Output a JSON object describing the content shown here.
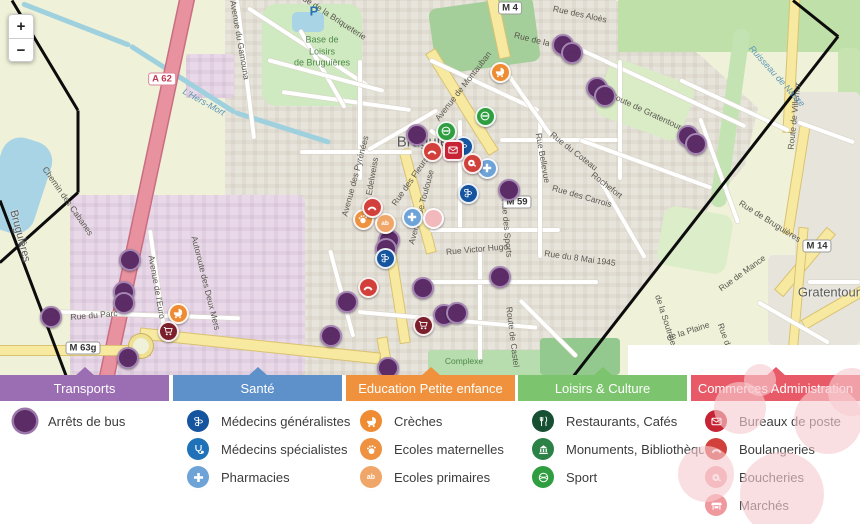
{
  "map": {
    "controls": {
      "zoom_in": "+",
      "zoom_out": "−"
    },
    "towns": [
      {
        "text": "Bruguières",
        "x": 433,
        "y": 142,
        "size": 15,
        "rot": 0
      },
      {
        "text": "Gratentour",
        "x": 829,
        "y": 292,
        "size": 13,
        "rot": 0
      },
      {
        "text": "Bruguières",
        "x": 20,
        "y": 236,
        "size": 11,
        "rot": 75
      }
    ],
    "park_label": {
      "lines": [
        "Base de",
        "Loisirs",
        "de Bruguières"
      ],
      "x": 322,
      "y": 52
    },
    "area_label": {
      "text": "Complexe",
      "x": 464,
      "y": 361
    },
    "parking_label": {
      "text": "P",
      "x": 314,
      "y": 11
    },
    "water_labels": [
      {
        "text": "L'Hers-Mort",
        "x": 204,
        "y": 102,
        "rot": 29
      },
      {
        "text": "Ruisseau de Nauze",
        "x": 777,
        "y": 76,
        "rot": 48
      }
    ],
    "street_labels": [
      {
        "text": "Rue de la Briqueterie",
        "x": 332,
        "y": 16,
        "rot": 33
      },
      {
        "text": "Avenue du Gamouna",
        "x": 240,
        "y": 40,
        "rot": 80
      },
      {
        "text": "Avenue de Montauban",
        "x": 463,
        "y": 86,
        "rot": -52
      },
      {
        "text": "Rue des Aloès",
        "x": 580,
        "y": 14,
        "rot": 12
      },
      {
        "text": "Rue de la",
        "x": 532,
        "y": 39,
        "rot": 14
      },
      {
        "text": "Route de Gratentour",
        "x": 646,
        "y": 111,
        "rot": 25
      },
      {
        "text": "Rue du Coteau",
        "x": 574,
        "y": 151,
        "rot": 38
      },
      {
        "text": "Rochefort",
        "x": 607,
        "y": 185,
        "rot": 38
      },
      {
        "text": "Rue Bellevue",
        "x": 543,
        "y": 158,
        "rot": 80
      },
      {
        "text": "Rue des Carrois",
        "x": 582,
        "y": 196,
        "rot": 16
      },
      {
        "text": "Rue du 8 Mai 1945",
        "x": 580,
        "y": 258,
        "rot": 8
      },
      {
        "text": "Rue de Bruguières",
        "x": 770,
        "y": 221,
        "rot": 32
      },
      {
        "text": "Rue de Mance",
        "x": 742,
        "y": 273,
        "rot": -36
      },
      {
        "text": "Rue du Barry",
        "x": 729,
        "y": 347,
        "rot": 70
      },
      {
        "text": "de la Plaine",
        "x": 688,
        "y": 331,
        "rot": -18
      },
      {
        "text": "de la Soutrine",
        "x": 666,
        "y": 320,
        "rot": 72
      },
      {
        "text": "Avenue des Pyrénées",
        "x": 355,
        "y": 176,
        "rot": -75
      },
      {
        "text": "Rue des Edelweiss",
        "x": 369,
        "y": 193,
        "rot": -80
      },
      {
        "text": "Rue des Fleurs",
        "x": 410,
        "y": 181,
        "rot": -55
      },
      {
        "text": "Avenue de Toulouse",
        "x": 421,
        "y": 207,
        "rot": -75
      },
      {
        "text": "Rue Victor Hugo",
        "x": 477,
        "y": 249,
        "rot": -5
      },
      {
        "text": "Rue des Sports",
        "x": 507,
        "y": 228,
        "rot": 85
      },
      {
        "text": "Route de Castel",
        "x": 513,
        "y": 337,
        "rot": 83
      },
      {
        "text": "Rue du Parc",
        "x": 94,
        "y": 315,
        "rot": -5
      },
      {
        "text": "Avenue de l'Euro",
        "x": 157,
        "y": 287,
        "rot": 80
      },
      {
        "text": "Chemin des Cabanes",
        "x": 68,
        "y": 201,
        "rot": 55
      },
      {
        "text": "Autoroute des Deux Mers",
        "x": 206,
        "y": 283,
        "rot": 76
      },
      {
        "text": "Route de Villemur",
        "x": 794,
        "y": 116,
        "rot": -84
      }
    ],
    "shields": [
      {
        "text": "A 62",
        "x": 162,
        "y": 79,
        "kind": "motorway"
      },
      {
        "text": "M 4",
        "x": 510,
        "y": 8,
        "kind": "local"
      },
      {
        "text": "M 59",
        "x": 517,
        "y": 202,
        "kind": "local"
      },
      {
        "text": "M 14",
        "x": 817,
        "y": 246,
        "kind": "local"
      },
      {
        "text": "M 63g",
        "x": 83,
        "y": 348,
        "kind": "local"
      }
    ],
    "regions": [
      {
        "x": 186,
        "y": 54,
        "w": 48,
        "h": 44,
        "rot": 0,
        "color": "#e9d9e8",
        "cls": "indu",
        "r": 4
      },
      {
        "x": 70,
        "y": 195,
        "w": 235,
        "h": 180,
        "rot": 0,
        "color": "#e9d9e8",
        "cls": "indu",
        "r": 8
      },
      {
        "x": 262,
        "y": 4,
        "w": 100,
        "h": 102,
        "rot": 0,
        "color": "#cfe9c0",
        "r": 14
      },
      {
        "x": 292,
        "y": 12,
        "w": 32,
        "h": 20,
        "rot": 0,
        "color": "#a9d4e5",
        "r": 5
      },
      {
        "x": 432,
        "y": 2,
        "w": 105,
        "h": 66,
        "rot": -8,
        "color": "#a4cf9a",
        "r": 8
      },
      {
        "x": 618,
        "y": 0,
        "w": 242,
        "h": 52,
        "rot": 0,
        "color": "#bfe0a8",
        "r": 0
      },
      {
        "x": 838,
        "y": 48,
        "w": 22,
        "h": 80,
        "rot": 0,
        "color": "#c7e4b0",
        "r": 6
      },
      {
        "x": 722,
        "y": 28,
        "w": 16,
        "h": 180,
        "rot": 8,
        "color": "#c3e3b2",
        "r": 8
      },
      {
        "x": 600,
        "y": 70,
        "w": 90,
        "h": 60,
        "rot": 20,
        "color": "#d9ecc6",
        "r": 12
      },
      {
        "x": 660,
        "y": 210,
        "w": 70,
        "h": 60,
        "rot": 10,
        "color": "#dcedc9",
        "r": 12
      },
      {
        "x": 795,
        "y": 92,
        "w": 65,
        "h": 170,
        "rot": 0,
        "color": "#e7e4dc",
        "r": 6
      },
      {
        "x": 768,
        "y": 255,
        "w": 92,
        "h": 90,
        "rot": 0,
        "color": "#e7e4dc",
        "r": 6
      },
      {
        "x": 428,
        "y": 350,
        "w": 130,
        "h": 25,
        "rot": 0,
        "color": "#b7dcae",
        "r": 4
      },
      {
        "x": 540,
        "y": 338,
        "w": 80,
        "h": 37,
        "rot": 0,
        "color": "#93c98f",
        "r": 4
      },
      {
        "x": -8,
        "y": 138,
        "w": 52,
        "h": 95,
        "rot": 18,
        "color": "#a9d4e5",
        "r": 20
      }
    ],
    "rivers": [
      [
        22,
        3,
        130,
        45
      ],
      [
        130,
        45,
        235,
        112
      ],
      [
        235,
        112,
        330,
        142
      ]
    ],
    "motorway": {
      "x": 140,
      "y": -12,
      "w": 13,
      "h": 404,
      "rot": 12
    },
    "yellow_roads": [
      {
        "x": 493,
        "y": -8,
        "w": 10,
        "h": 66,
        "rot": -12
      },
      {
        "x": 457,
        "y": 43,
        "w": 10,
        "h": 118,
        "rot": -32
      },
      {
        "x": 413,
        "y": 148,
        "w": 9,
        "h": 106,
        "rot": -15
      },
      {
        "x": 393,
        "y": 245,
        "w": 9,
        "h": 98,
        "rot": -9
      },
      {
        "x": 381,
        "y": 338,
        "w": 9,
        "h": 40,
        "rot": -10
      },
      {
        "x": 0,
        "y": 346,
        "w": 150,
        "h": 9,
        "rot": 0
      },
      {
        "x": 140,
        "y": 341,
        "w": 240,
        "h": 10,
        "rot": 6
      },
      {
        "x": 787,
        "y": -4,
        "w": 9,
        "h": 136,
        "rot": 3
      },
      {
        "x": 792,
        "y": 126,
        "w": 9,
        "h": 108,
        "rot": 9
      },
      {
        "x": 800,
        "y": 222,
        "w": 10,
        "h": 80,
        "rot": 40
      },
      {
        "x": 830,
        "y": 272,
        "w": 9,
        "h": 70,
        "rot": 60
      },
      {
        "x": 793,
        "y": 228,
        "w": 8,
        "h": 150,
        "rot": 5
      }
    ],
    "roundabout": {
      "x": 137,
      "y": 342
    },
    "streets": [
      [
        248,
        8,
        33,
        150
      ],
      [
        237,
        0,
        83,
        140
      ],
      [
        282,
        92,
        8,
        130
      ],
      [
        300,
        30,
        60,
        90
      ],
      [
        360,
        60,
        90,
        120
      ],
      [
        300,
        152,
        0,
        112
      ],
      [
        430,
        130,
        35,
        80
      ],
      [
        460,
        120,
        90,
        110
      ],
      [
        430,
        230,
        0,
        130
      ],
      [
        500,
        140,
        0,
        118
      ],
      [
        540,
        118,
        90,
        140
      ],
      [
        480,
        252,
        90,
        108
      ],
      [
        430,
        282,
        0,
        168
      ],
      [
        358,
        312,
        5,
        180
      ],
      [
        520,
        300,
        45,
        80
      ],
      [
        560,
        40,
        25,
        205
      ],
      [
        620,
        60,
        90,
        120
      ],
      [
        680,
        80,
        25,
        120
      ],
      [
        580,
        140,
        20,
        140
      ],
      [
        600,
        180,
        60,
        90
      ],
      [
        330,
        250,
        75,
        90
      ],
      [
        60,
        312,
        2,
        180
      ],
      [
        150,
        230,
        82,
        112
      ],
      [
        700,
        118,
        70,
        112
      ],
      [
        798,
        122,
        20,
        60
      ],
      [
        808,
        282,
        0,
        52
      ],
      [
        758,
        302,
        30,
        82
      ],
      [
        268,
        60,
        15,
        120
      ],
      [
        430,
        60,
        25,
        120
      ],
      [
        505,
        70,
        55,
        80
      ],
      [
        368,
        150,
        -30,
        80
      ]
    ],
    "boundary": [
      [
        12,
        0,
        78,
        110
      ],
      [
        78,
        110,
        78,
        192
      ],
      [
        78,
        192,
        0,
        262
      ],
      [
        0,
        200,
        66,
        375
      ],
      [
        793,
        0,
        838,
        36
      ],
      [
        838,
        36,
        574,
        375
      ]
    ],
    "marker_colors": {
      "bus": "#5b2c66",
      "creche": "#ee8b33",
      "nursery": "#ee9140",
      "primary": "#f0a668",
      "sport": "#2f9e41",
      "doctor": "#15549e",
      "pharmacy": "#6ea3d8",
      "butcher": "#d2403c",
      "bakery": "#d2403c",
      "post": "#c62434",
      "market": "#7a1f2b",
      "faded": "#f2b9bd"
    },
    "markers": [
      {
        "type": "bus",
        "x": 563,
        "y": 45
      },
      {
        "type": "bus",
        "x": 572,
        "y": 53
      },
      {
        "type": "bus",
        "x": 597,
        "y": 88
      },
      {
        "type": "bus",
        "x": 605,
        "y": 96
      },
      {
        "type": "bus",
        "x": 688,
        "y": 136
      },
      {
        "type": "bus",
        "x": 696,
        "y": 144
      },
      {
        "type": "bus",
        "x": 417,
        "y": 135
      },
      {
        "type": "bus",
        "x": 509,
        "y": 190
      },
      {
        "type": "bus",
        "x": 389,
        "y": 240
      },
      {
        "type": "bus",
        "x": 386,
        "y": 249
      },
      {
        "type": "bus",
        "x": 423,
        "y": 288
      },
      {
        "type": "bus",
        "x": 444,
        "y": 315
      },
      {
        "type": "bus",
        "x": 457,
        "y": 313
      },
      {
        "type": "bus",
        "x": 347,
        "y": 302
      },
      {
        "type": "bus",
        "x": 331,
        "y": 336
      },
      {
        "type": "bus",
        "x": 500,
        "y": 277
      },
      {
        "type": "bus",
        "x": 130,
        "y": 260
      },
      {
        "type": "bus",
        "x": 124,
        "y": 292
      },
      {
        "type": "bus",
        "x": 124,
        "y": 303
      },
      {
        "type": "bus",
        "x": 51,
        "y": 317
      },
      {
        "type": "bus",
        "x": 128,
        "y": 358
      },
      {
        "type": "bus",
        "x": 388,
        "y": 368
      },
      {
        "type": "creche",
        "x": 500,
        "y": 72
      },
      {
        "type": "creche",
        "x": 178,
        "y": 313
      },
      {
        "type": "nursery",
        "x": 363,
        "y": 219
      },
      {
        "type": "primary",
        "x": 385,
        "y": 223
      },
      {
        "type": "sport",
        "x": 485,
        "y": 116
      },
      {
        "type": "sport",
        "x": 446,
        "y": 131
      },
      {
        "type": "doctor",
        "x": 463,
        "y": 146
      },
      {
        "type": "doctor",
        "x": 468,
        "y": 193
      },
      {
        "type": "doctor",
        "x": 385,
        "y": 258
      },
      {
        "type": "pharmacy",
        "x": 487,
        "y": 168
      },
      {
        "type": "pharmacy",
        "x": 412,
        "y": 217
      },
      {
        "type": "butcher",
        "x": 472,
        "y": 163
      },
      {
        "type": "bakery",
        "x": 432,
        "y": 151
      },
      {
        "type": "bakery",
        "x": 372,
        "y": 207
      },
      {
        "type": "bakery",
        "x": 368,
        "y": 287
      },
      {
        "type": "post",
        "x": 453,
        "y": 150
      },
      {
        "type": "market",
        "x": 423,
        "y": 325
      },
      {
        "type": "market",
        "x": 168,
        "y": 331
      },
      {
        "type": "faded",
        "x": 433,
        "y": 218
      }
    ]
  },
  "legend": {
    "sections": [
      {
        "title": "Transports",
        "color": "#9b6db3",
        "items": [
          {
            "icon": "bus-icon",
            "glyph": "bus",
            "label": "Arrêts de bus",
            "color": "#5b2c66"
          }
        ]
      },
      {
        "title": "Santé",
        "color": "#5e90ca",
        "items": [
          {
            "icon": "caduceus-icon",
            "glyph": "caduceus",
            "label": "Médecins généralistes",
            "color": "#15549e"
          },
          {
            "icon": "stethoscope-icon",
            "glyph": "steth",
            "label": "Médecins spécialistes",
            "color": "#1f72b8"
          },
          {
            "icon": "cross-icon",
            "glyph": "cross",
            "label": "Pharmacies",
            "color": "#6ea3d8"
          }
        ]
      },
      {
        "title": "Education Petite enfance",
        "color": "#f0913d",
        "items": [
          {
            "icon": "pram-icon",
            "glyph": "pram",
            "label": "Crèches",
            "color": "#ee8b33"
          },
          {
            "icon": "hand-icon",
            "glyph": "hand",
            "label": "Ecoles maternelles",
            "color": "#ee9140"
          },
          {
            "icon": "abc-icon",
            "glyph": "abc",
            "label": "Ecoles primaires",
            "color": "#f0a668"
          }
        ]
      },
      {
        "title": "Loisirs & Culture",
        "color": "#7cc46d",
        "items": [
          {
            "icon": "restaurant-icon",
            "glyph": "fork",
            "label": "Restaurants, Cafés",
            "color": "#174f33"
          },
          {
            "icon": "monument-icon",
            "glyph": "monument",
            "label": "Monuments, Bibliothèques",
            "color": "#2c8246"
          },
          {
            "icon": "ball-icon",
            "glyph": "ball",
            "label": "Sport",
            "color": "#2f9e41"
          }
        ]
      },
      {
        "title": "Commerces Administration",
        "color": "#e85a68",
        "items": [
          {
            "icon": "envelope-icon",
            "glyph": "envelope",
            "label": "Bureaux de poste",
            "color": "#c62434"
          },
          {
            "icon": "croissant-icon",
            "glyph": "croissant",
            "label": "Boulangeries",
            "color": "#d2403c"
          },
          {
            "icon": "meat-icon",
            "glyph": "meat",
            "label": "Boucheries",
            "color": "#f0a3a8"
          },
          {
            "icon": "stall-icon",
            "glyph": "stall",
            "label": "Marchés",
            "color": "#ef989e"
          }
        ]
      }
    ],
    "fade_blobs": [
      [
        740,
        33,
        26
      ],
      [
        828,
        45,
        34
      ],
      [
        706,
        99,
        28
      ],
      [
        782,
        119,
        42
      ],
      [
        852,
        17,
        24
      ],
      [
        760,
        5,
        16
      ]
    ]
  }
}
